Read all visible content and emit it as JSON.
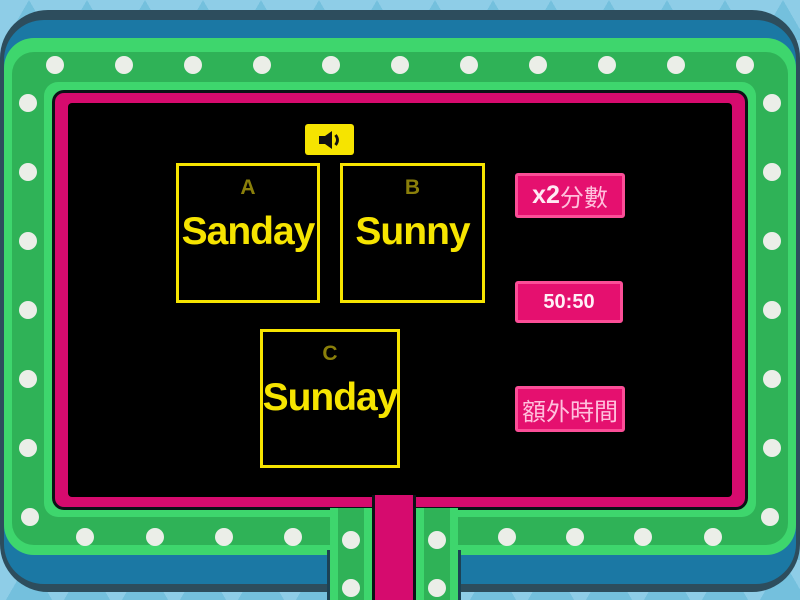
{
  "question": {
    "audio_icon": "speaker-icon"
  },
  "options": [
    {
      "letter": "A",
      "text": "Sanday"
    },
    {
      "letter": "B",
      "text": "Sunny"
    },
    {
      "letter": "C",
      "text": "Sunday"
    }
  ],
  "powerups": {
    "double_points": {
      "prefix": "x2",
      "suffix": "分數"
    },
    "fifty_fifty": {
      "label": "50:50"
    },
    "extra_time": {
      "label": "額外時間"
    }
  },
  "colors": {
    "sky": "#8ecde7",
    "body_blue": "#1b78a4",
    "frame_green": "#3ed66d",
    "frame_green_dark": "#2fb257",
    "frame_pink": "#d60b6e",
    "screen_black": "#000000",
    "accent_yellow": "#f6e400",
    "option_letter_olive": "#8a7f0a",
    "powerup_pink": "#e5106f",
    "powerup_border_pink": "#fb4e97",
    "light_dot": "#ebeee8"
  }
}
